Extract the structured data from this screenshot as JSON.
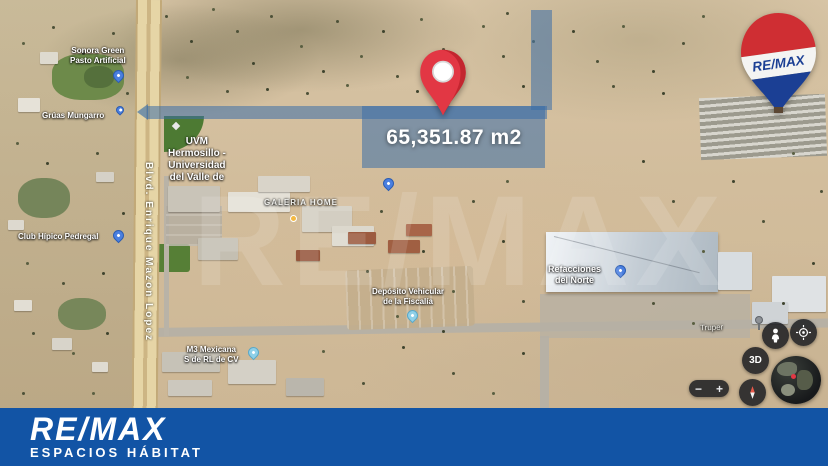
{
  "branding": {
    "agency_name": "RE/MAX",
    "agency_tagline": "ESPACIOS HÁBITAT",
    "balloon_label": "RE/MAX",
    "watermark": "RE/MAX",
    "bar_color": "#1254a5",
    "balloon_red": "#cf2e33",
    "balloon_blue": "#1b3f94"
  },
  "listing": {
    "area_label": "65,351.87 m2",
    "overlay_color": "#3a6ea8",
    "marker_color": "#e23744"
  },
  "map": {
    "road_label": "Blvd. Enrique Mazon Lopez",
    "street_label": "Truper",
    "pois": {
      "sonora_line1": "Sonora Green",
      "sonora_line2": "Pasto Artificial",
      "gruas": "Grúas Mungarro",
      "uvm_line1": "UVM",
      "uvm_line2": "Hermosillo -",
      "uvm_line3": "Universidad",
      "uvm_line4": "del Valle de",
      "club": "Club Hípico Pedregal",
      "galeria": "GALERIA HOME",
      "deposito_line1": "Depósito Vehicular",
      "deposito_line2": "de la Fiscalía",
      "m3_line1": "M3 Mexicana",
      "m3_line2": "S de RL de CV",
      "norte_line1": "Refacciones",
      "norte_line2": "del Norte"
    }
  },
  "controls": {
    "tilt": "3D",
    "zoom_out": "−",
    "zoom_in": "+"
  }
}
